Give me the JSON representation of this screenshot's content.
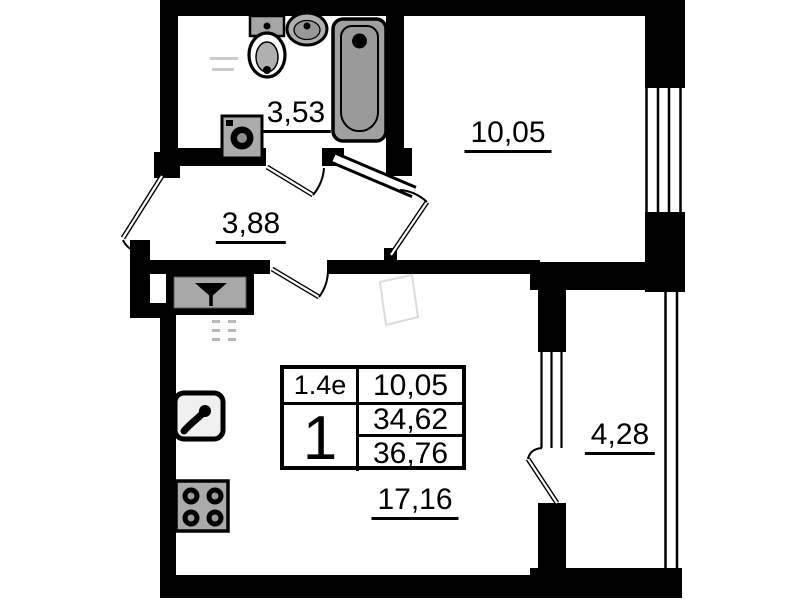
{
  "floor_plan": {
    "rooms": [
      {
        "name": "bathroom",
        "area": "3,53"
      },
      {
        "name": "bedroom",
        "area": "10,05"
      },
      {
        "name": "hallway",
        "area": "3,88"
      },
      {
        "name": "living-room",
        "area": "17,16"
      },
      {
        "name": "balcony",
        "area": "4,28"
      }
    ],
    "info_table": {
      "plan_code": "1.4e",
      "room_count": "1",
      "living_area": "10,05",
      "area_without_balcony": "34,62",
      "total_area": "36,76"
    },
    "fixtures": [
      "toilet",
      "wash-basin",
      "bathtub",
      "washing-machine",
      "vent-shaft",
      "kitchen-sink",
      "stove"
    ],
    "colors": {
      "wall": "#000000",
      "fixture_fill": "#a3a3a3",
      "background": "#ffffff"
    }
  }
}
